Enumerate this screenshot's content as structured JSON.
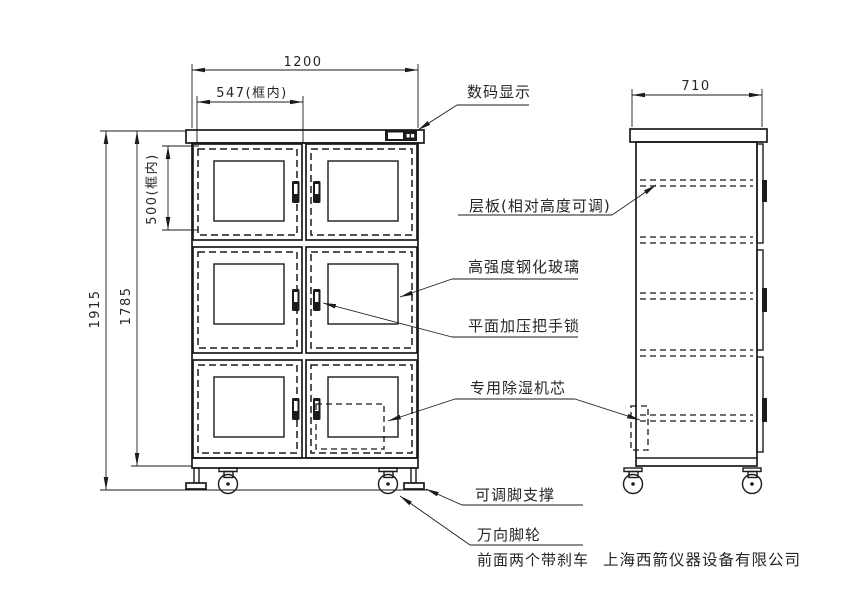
{
  "drawing": {
    "dims": {
      "overall_width": "1200",
      "inner_width": "547(框内)",
      "inner_height": "500(框内)",
      "total_height": "1915",
      "body_height": "1785",
      "depth": "710"
    },
    "callouts": {
      "display": "数码显示",
      "shelf": "层板(相对高度可调)",
      "glass": "高强度钢化玻璃",
      "handle": "平面加压把手锁",
      "dehumidifier": "专用除湿机芯",
      "foot": "可调脚支撑",
      "caster": "万向脚轮",
      "caster_note": "前面两个带刹车"
    },
    "company": "上海西箭仪器设备有限公司",
    "colors": {
      "line": "#1b1b1b",
      "background": "#ffffff"
    }
  }
}
